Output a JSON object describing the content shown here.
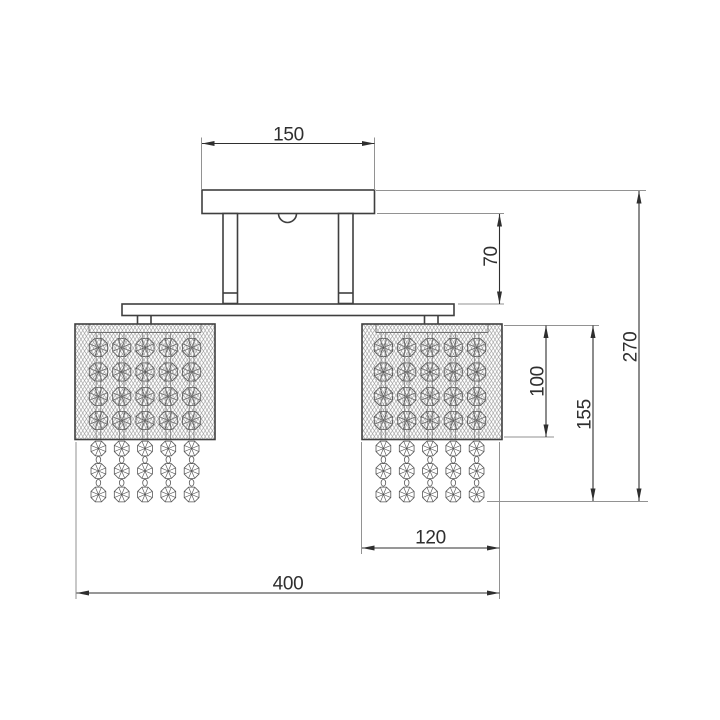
{
  "drawing": {
    "background": "#ffffff",
    "dimension_labels": {
      "canopy_width": "150",
      "stem_drop": "70",
      "shade_height": "100",
      "shade_with_crystals_height": "155",
      "overall_height": "270",
      "shade_width": "120",
      "overall_width": "400"
    },
    "colors": {
      "outline": "#3f3f3f",
      "dimension_line": "#2f2f2f",
      "extension_line": "#929292",
      "mesh": "#909090",
      "crystal": "#565656",
      "label_text": "#2f2f2f"
    }
  }
}
